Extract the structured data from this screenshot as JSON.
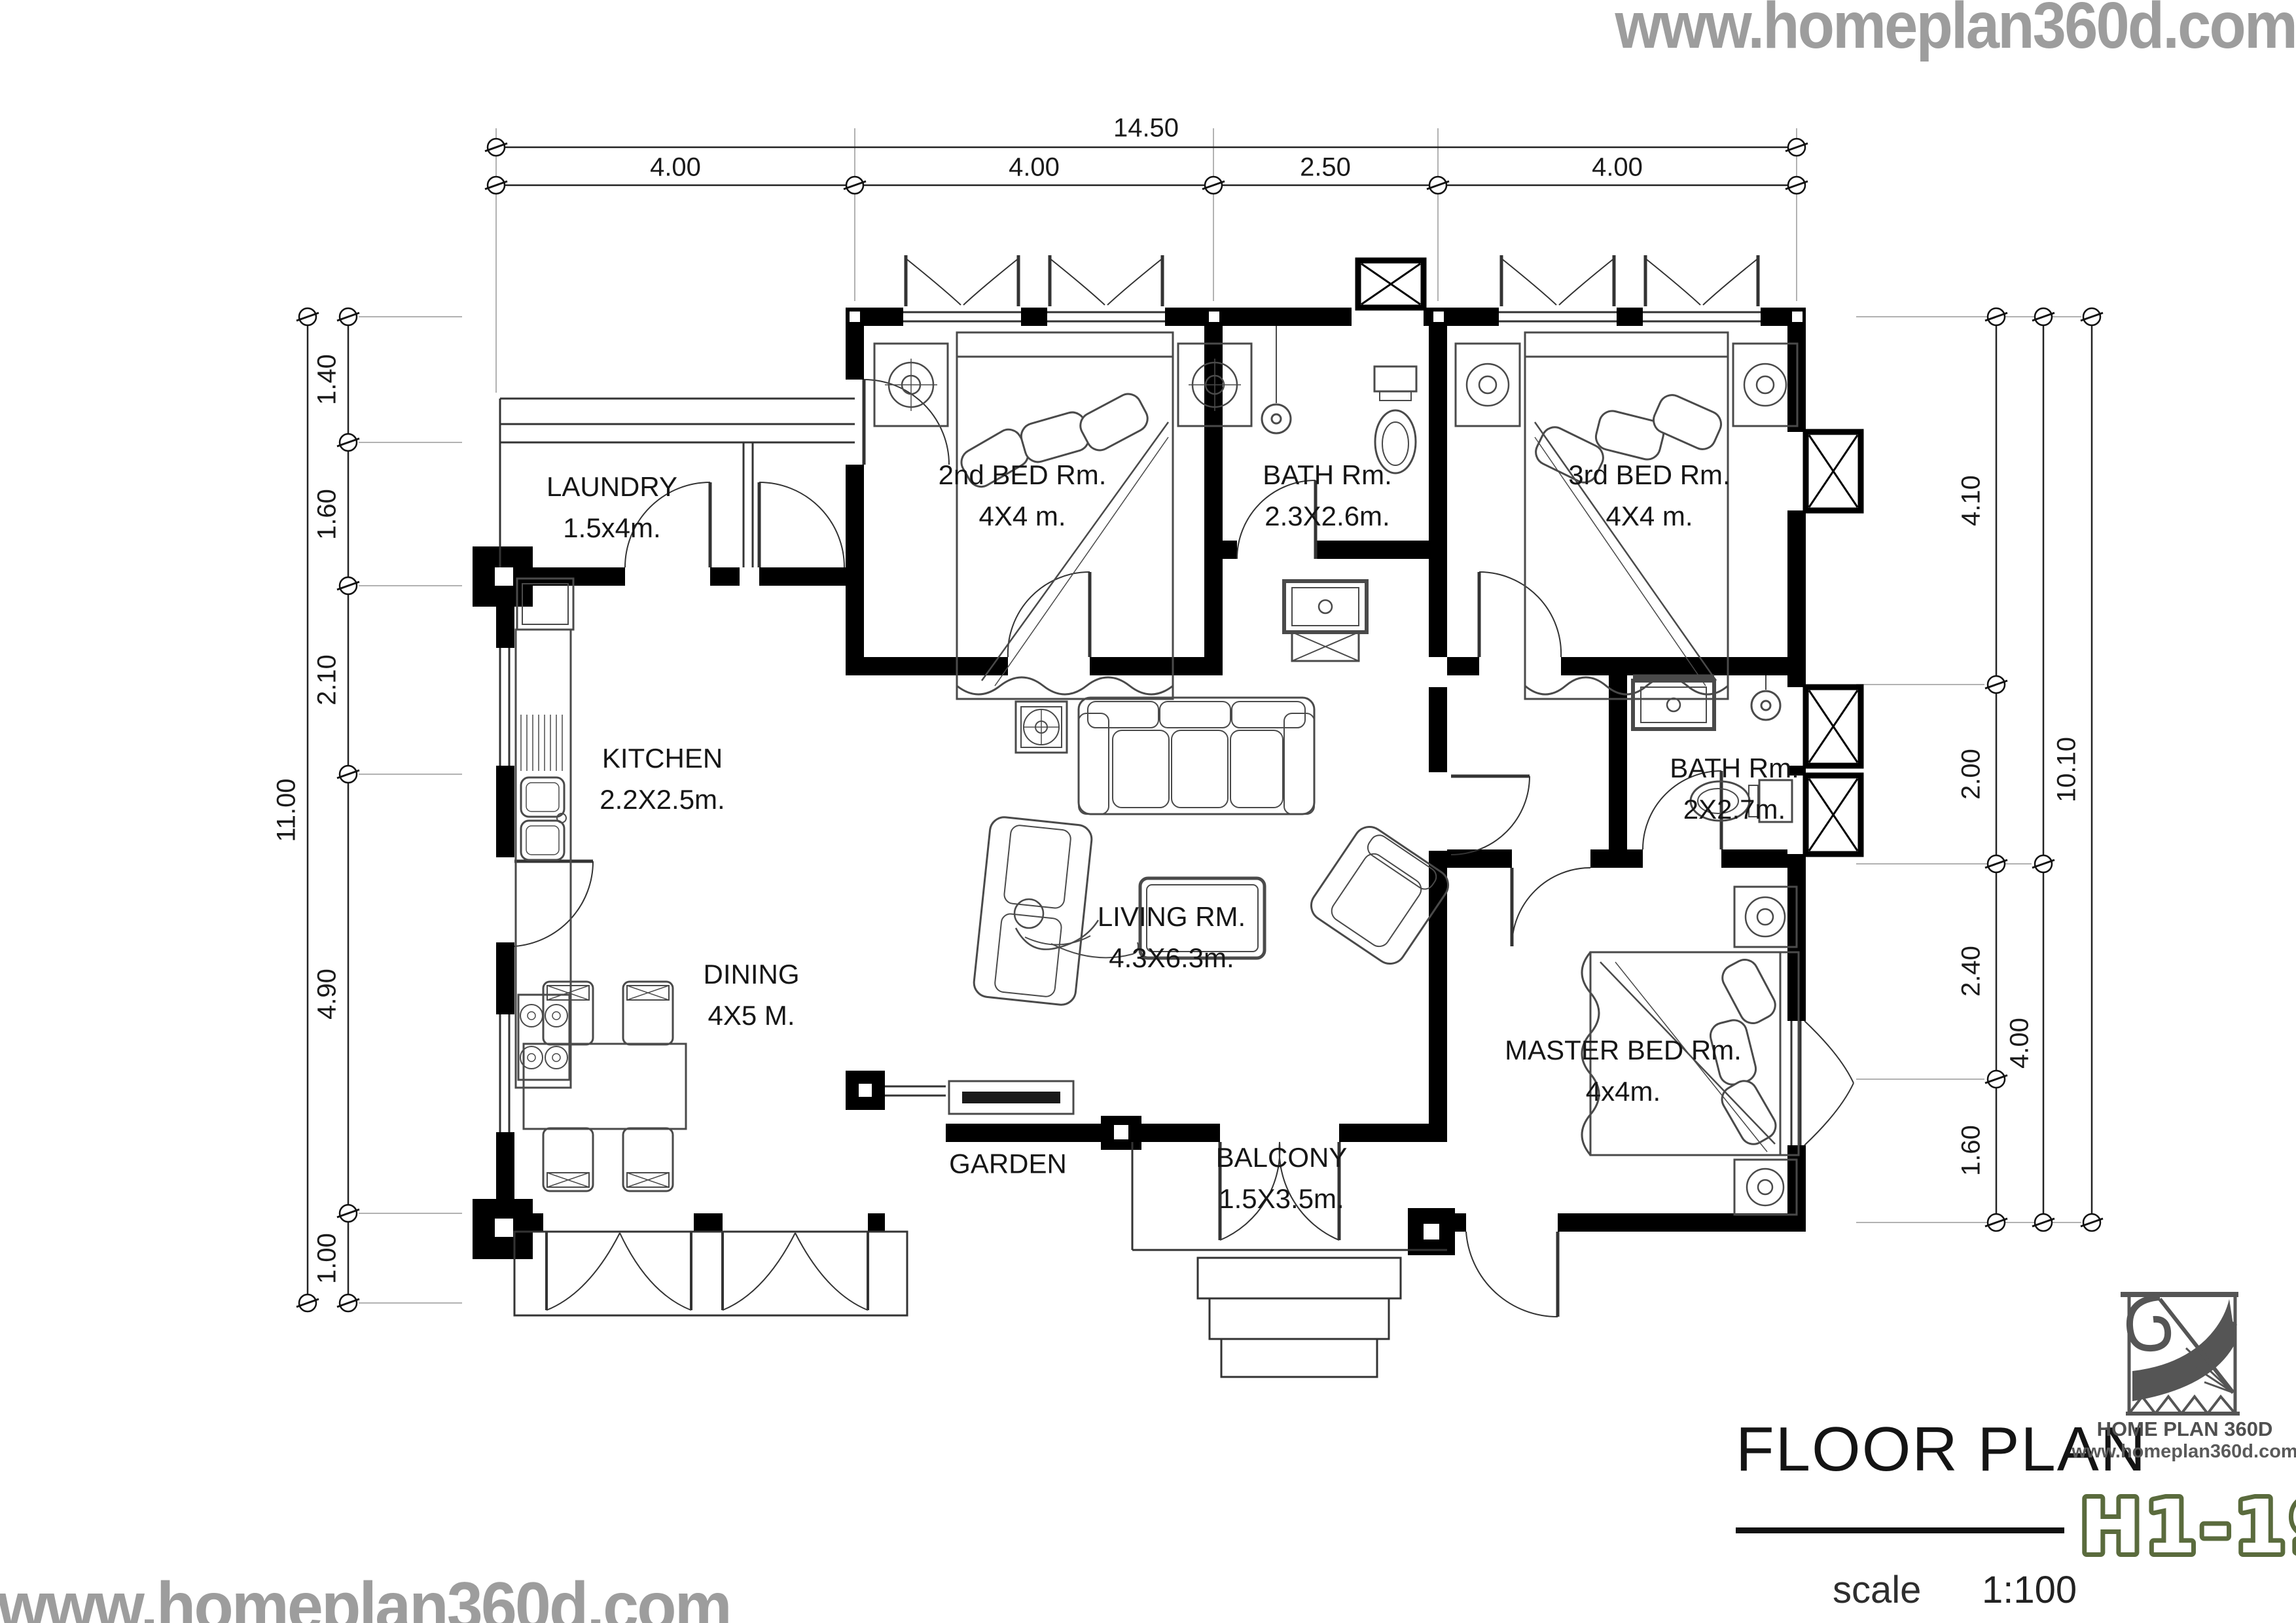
{
  "watermarks": {
    "top_right": "www.homeplan360d.com",
    "bottom_left": "www.homeplan360d.com"
  },
  "dimensions": {
    "top": {
      "total": "14.50",
      "segments": [
        "4.00",
        "4.00",
        "2.50",
        "4.00"
      ]
    },
    "left": {
      "total": "11.00",
      "segments": [
        "1.40",
        "1.60",
        "2.10",
        "4.90",
        "1.00"
      ]
    },
    "right": {
      "total": "10.10",
      "segments": [
        "4.10",
        "2.00",
        "2.40",
        "1.60"
      ],
      "span": "4.00"
    }
  },
  "rooms": {
    "laundry": {
      "name": "LAUNDRY",
      "size": "1.5x4m."
    },
    "bed2": {
      "name": "2nd BED Rm.",
      "size": "4X4 m."
    },
    "bath_top": {
      "name": "BATH Rm.",
      "size": "2.3X2.6m."
    },
    "bed3": {
      "name": "3rd BED Rm.",
      "size": "4X4 m."
    },
    "kitchen": {
      "name": "KITCHEN",
      "size": "2.2X2.5m."
    },
    "living": {
      "name": "LIVING RM.",
      "size": "4.3X6.3m."
    },
    "bath_master": {
      "name": "BATH Rm.",
      "size": "2X2.7m."
    },
    "dining": {
      "name": "DINING",
      "size": "4X5 M."
    },
    "master": {
      "name": "MASTER BED Rm.",
      "size": "4x4m."
    },
    "garden": {
      "name": "GARDEN"
    },
    "balcony": {
      "name": "BALCONY",
      "size": "1.5X3.5m."
    }
  },
  "title_block": {
    "title": "FLOOR PLAN",
    "scale_label": "scale",
    "scale_value": "1:100",
    "plan_code": "H1-19",
    "logo_name": "HOME PLAN 360D",
    "logo_site": "www.homeplan360d.com"
  },
  "colors": {
    "walls": "#000000",
    "furniture_line": "#4a4a4a",
    "watermark_gray": "#9d9d9d",
    "plan_code_green": "#5a6b3d",
    "logo_gray": "#555555"
  }
}
